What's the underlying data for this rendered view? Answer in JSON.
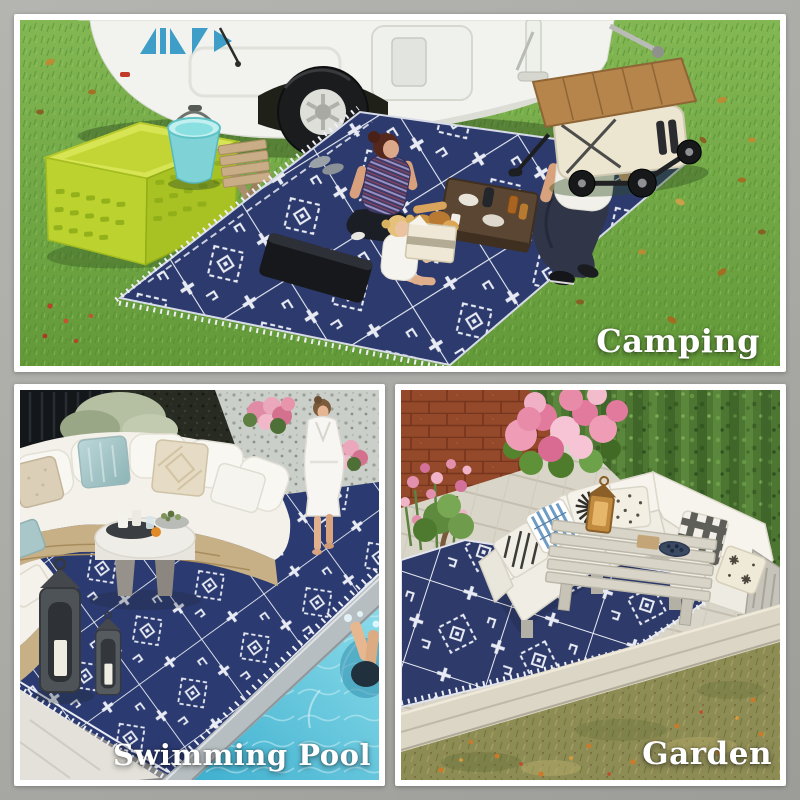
{
  "image": {
    "kind": "product lifestyle collage",
    "subject": "blue and white geometric reversible outdoor rug shown in three settings",
    "frame_background": "#a9a9a5",
    "panel_border_color": "#ffffff",
    "label_color": "#ffffff"
  },
  "rug": {
    "base_color": "#2c3a6d",
    "pattern_color": "#e8ebf3",
    "style": "moroccan geometric lattice with crosses, serrated diamonds, hooks and fringe edge"
  },
  "panels": [
    {
      "id": "camping",
      "label": "Camping",
      "setting": "green lawn beside a white camper trailer",
      "objects": [
        "white camper trailer with blue logo and wheel",
        "lime green storage crate",
        "teal bucket",
        "wooden slat stool",
        "woman, child and man picnicking on rug",
        "picnic basket with bread",
        "low wooden snack table",
        "black seat cushion",
        "collapsible wagon cart with wood top",
        "scattered autumn leaves"
      ]
    },
    {
      "id": "swimming-pool",
      "label": "Swimming Pool",
      "setting": "poolside patio with gravel garden",
      "objects": [
        "curved rattan sectional sofa with white cushions",
        "beige and teal throw pillows",
        "round white coffee table with drinks tray and succulents",
        "woman in white bathrobe",
        "black metal candle lanterns",
        "pink flowers with concrete planter",
        "pool coping and blue water",
        "swimmer in pool"
      ]
    },
    {
      "id": "garden",
      "label": "Garden",
      "setting": "backyard wood deck with hedge and brick wall",
      "objects": [
        "white wood sectional sofa with patterned pillows",
        "slatted wood coffee table with lantern and berry bowl",
        "pink hydrangea bush",
        "pink border flowers",
        "clay planter pot with small tree",
        "green vine hedge wall",
        "terracotta brick wall",
        "deck edge beam over autumn grass"
      ]
    }
  ]
}
